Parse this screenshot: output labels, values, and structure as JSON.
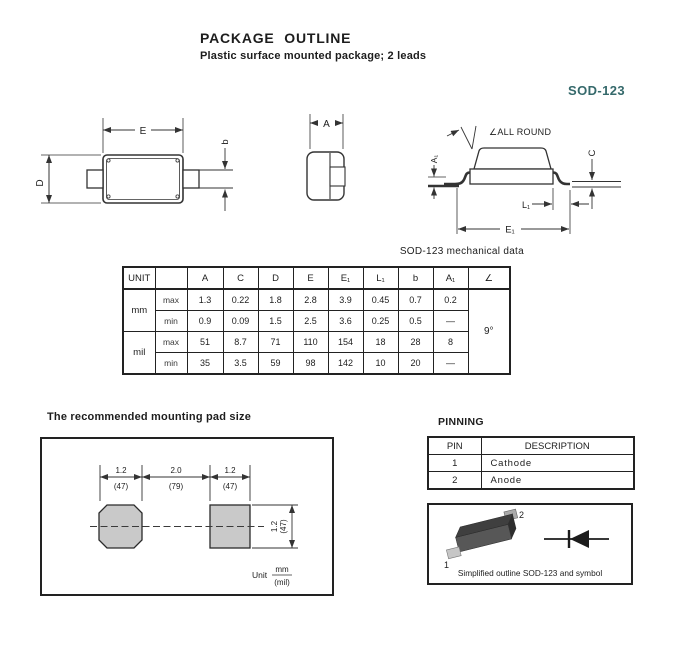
{
  "header": {
    "title": "PACKAGE OUTLINE",
    "subtitle": "Plastic surface mounted package; 2 leads",
    "package_name": "SOD-123"
  },
  "colors": {
    "accent_teal": "#35696b",
    "line": "#333333",
    "pad_fill": "#c9c9c9"
  },
  "drawings": {
    "top_view": {
      "dim_width": "E",
      "dim_length": "D",
      "dim_lead_width": "b"
    },
    "end_view": {
      "dim_body": "A"
    },
    "side_view": {
      "angle_note": "∠ALL ROUND",
      "dim_standoff": "A₁",
      "dim_lead_thickness": "C",
      "dim_foot_length": "L₁",
      "dim_span": "E₁"
    }
  },
  "mech_table": {
    "title": "SOD-123 mechanical data",
    "headers": [
      "UNIT",
      "",
      "A",
      "C",
      "D",
      "E",
      "E₁",
      "L₁",
      "b",
      "A₁",
      "∠"
    ],
    "unit_groups": [
      {
        "label": "mm"
      },
      {
        "label": "mil"
      }
    ],
    "rows": [
      {
        "bound": "max",
        "values": [
          "1.3",
          "0.22",
          "1.8",
          "2.8",
          "3.9",
          "0.45",
          "0.7",
          "0.2"
        ]
      },
      {
        "bound": "min",
        "values": [
          "0.9",
          "0.09",
          "1.5",
          "2.5",
          "3.6",
          "0.25",
          "0.5",
          "—"
        ]
      },
      {
        "bound": "max",
        "values": [
          "51",
          "8.7",
          "71",
          "110",
          "154",
          "18",
          "28",
          "8"
        ]
      },
      {
        "bound": "min",
        "values": [
          "35",
          "3.5",
          "59",
          "98",
          "142",
          "10",
          "20",
          "—"
        ]
      }
    ],
    "angle_value": "9°"
  },
  "mounting_pad": {
    "title": "The recommended mounting pad size",
    "dims_top": [
      {
        "mm": "1.2",
        "mil": "(47)"
      },
      {
        "mm": "2.0",
        "mil": "(79)"
      },
      {
        "mm": "1.2",
        "mil": "(47)"
      }
    ],
    "dim_side": {
      "mm": "1.2",
      "mil": "(47)"
    },
    "unit_note": {
      "label": "Unit",
      "numerator": "mm",
      "denominator": "(mil)"
    }
  },
  "pinning": {
    "title": "PINNING",
    "headers": [
      "PIN",
      "DESCRIPTION"
    ],
    "rows": [
      {
        "pin": "1",
        "description": "Cathode"
      },
      {
        "pin": "2",
        "description": "Anode"
      }
    ]
  },
  "outline_symbol": {
    "caption": "Simplified outline SOD-123 and symbol",
    "pin1_label": "1",
    "pin2_label": "2"
  }
}
